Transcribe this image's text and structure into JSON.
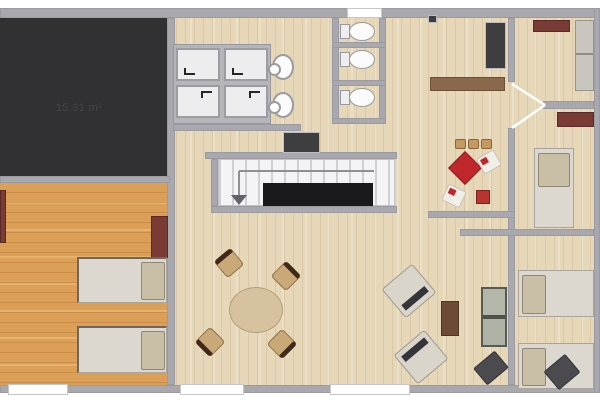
{
  "floorplan": {
    "area_label": "15.31 m²",
    "colors": {
      "wall": "#a8a8ae",
      "floor_light": "#e6d7b8",
      "floor_orange": "#db9f58",
      "dark_room": "#313134",
      "red_furniture": "#7a3a35",
      "kids_red": "#c0272d",
      "stair_void": "#1a1a1d",
      "bed_body": "#dcd8cf",
      "pillow": "#c9bfa7"
    },
    "rooms": [
      {
        "name": "dark room top-left",
        "label": "15.31 m²"
      },
      {
        "name": "left bedroom"
      },
      {
        "name": "main living hall"
      },
      {
        "name": "shower room"
      },
      {
        "name": "wc stalls"
      },
      {
        "name": "top-right room"
      },
      {
        "name": "middle-right bedroom"
      },
      {
        "name": "bottom-right bedroom"
      }
    ],
    "inventory": {
      "shower_trays": 4,
      "sinks": 2,
      "toilets": 3,
      "beds": 5,
      "windows": 4,
      "door_swings": 1,
      "staircases": 1,
      "dining_chairs": 4,
      "armchairs": 2,
      "kids_stools": 3,
      "sofas": 1,
      "poufs": 2
    }
  }
}
